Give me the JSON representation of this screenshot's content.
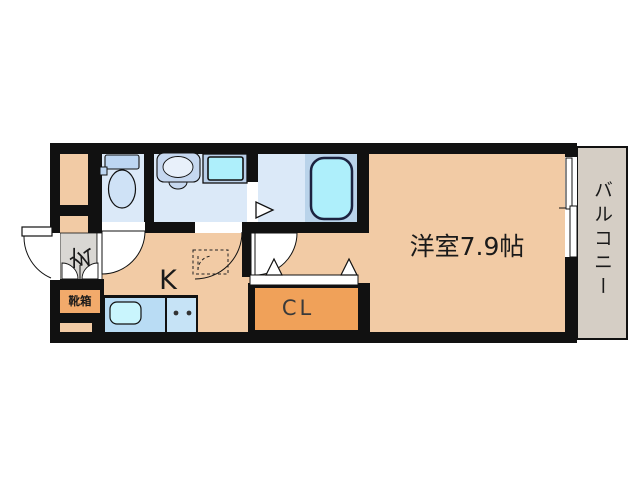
{
  "plan": {
    "type": "floor-plan",
    "labels": {
      "main_room": "洋室7.9帖",
      "kitchen": "K",
      "closet": "CL",
      "entrance": "玄",
      "shoe_box": "靴箱",
      "balcony": "バルコニー"
    },
    "colors": {
      "wall": "#111111",
      "floor_peach": "#f2cba5",
      "wet_room_blue": "#dbe9f8",
      "bath_panel_blue": "#b9d3ea",
      "fixture_blue": "#bdd6f2",
      "toilet_bowl_blue": "#cfe2f6",
      "sink_unit_blue": "#c6d8f0",
      "sink_basin": "#e8f0fa",
      "washer_pan_frame": "#b9cfe9",
      "cyan": "#aeeffb",
      "tub_outline": "#1c2340",
      "kitchen_sink_cyan": "#c9f5fd",
      "counter_blue": "#b9dcf4",
      "counter_blue_light": "#c6e3f6",
      "closet_orange": "#f0a159",
      "shoe_box_orange": "#f2aa6b",
      "entrance_gray": "#d9d7d3",
      "balcony_gray": "#d5cec5",
      "text": "#1a1a1a"
    }
  }
}
